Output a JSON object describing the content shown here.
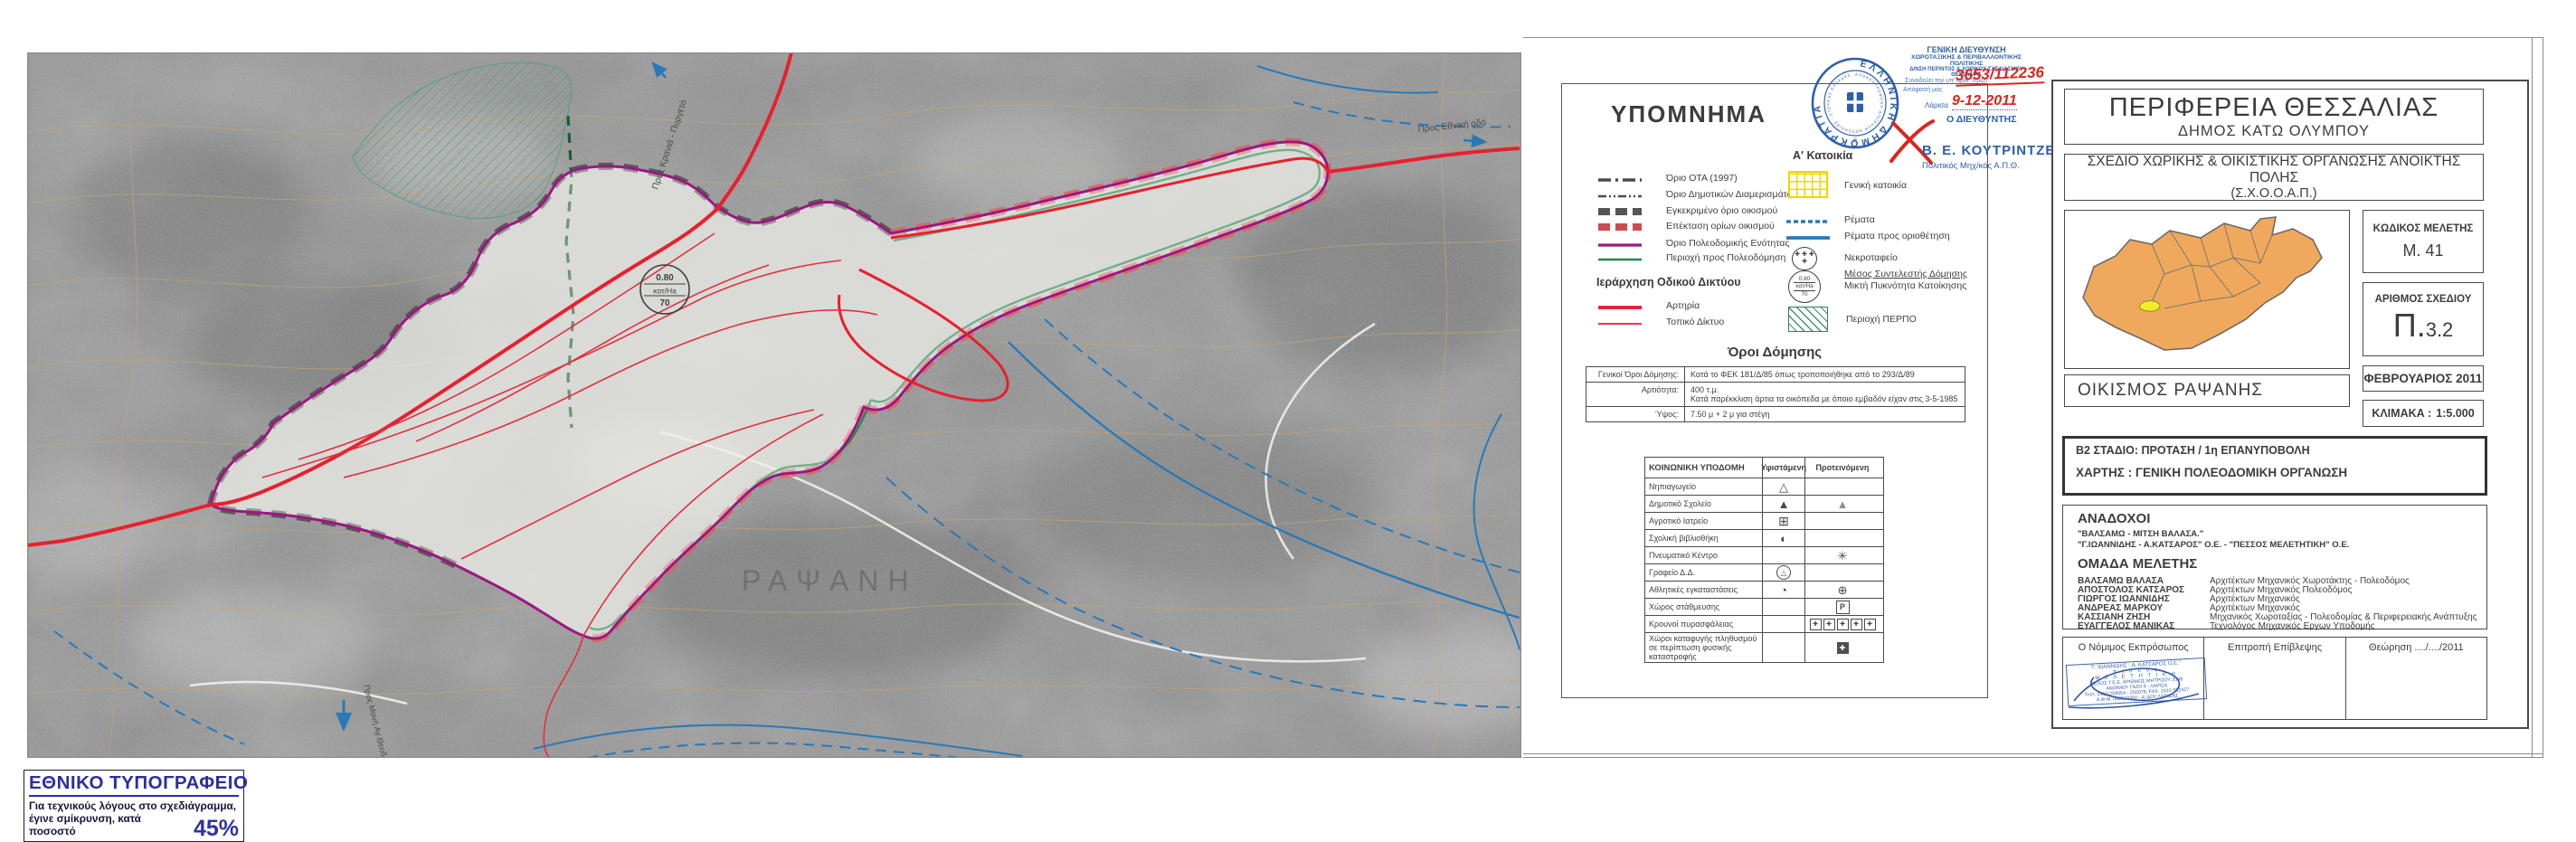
{
  "map": {
    "place_label": "ΡΑΨΑΝΗ",
    "label_north_road": "Προς Κρανιά - Πυργετό",
    "label_south_road": "Προς Μονή Αγ.Θεοδώρων",
    "label_east_road": "Προς Εθνική οδό",
    "density_circle": {
      "value": "0.80",
      "unit": "κατ/Ha",
      "density": "70"
    }
  },
  "legend": {
    "title": "ΥΠΟΜΝΗΜΑ",
    "boundaries": [
      {
        "label": "Όριο ΟΤΑ (1997)"
      },
      {
        "label": "Όριο Δημοτικών Διαμερισμάτων"
      },
      {
        "label": "Εγκεκριμένο όριο οικισμού"
      },
      {
        "label": "Επέκταση ορίων οικισμού"
      },
      {
        "label": "Όριο Πολεοδομικής Ενότητας"
      },
      {
        "label": "Περιοχή προς Πολεοδόμηση"
      }
    ],
    "roads_header": "Ιεράρχηση Οδικού Δικτύου",
    "roads": [
      {
        "label": "Αρτηρία"
      },
      {
        "label": "Τοπικό Δίκτυο"
      }
    ],
    "housing_header": "Α' Κατοικία",
    "area_items": [
      {
        "label": "Γενική κατοικία"
      },
      {
        "label": "Ρέματα"
      },
      {
        "label": "Ρέματα προς οριοθέτηση"
      },
      {
        "label": "Νεκροταφείο"
      },
      {
        "label": "Μέσος Συντελεστής Δόμησης",
        "label2": "Μικτή Πυκνότητα Κατοίκησης"
      },
      {
        "label": "Περιοχή ΠΕΡΠΟ"
      }
    ],
    "cemetery_glyphs": "✚ ✚ ✚ ✚",
    "building_terms": {
      "title": "Όροι Δόμησης",
      "rows": [
        {
          "label": "Γενικοί Όροι Δόμησης:",
          "value": "Κατά το ΦΕΚ 181/Δ/85 όπως τροποποιήθηκε από το 293/Δ/89",
          "value2": ""
        },
        {
          "label": "Αρτιότητα:",
          "value": "400 τ.μ.",
          "value2": "Κατά παρέκκλιση άρτια τα οικόπεδα με όποιο εμβαδόν είχαν στις 3-5-1985"
        },
        {
          "label": "Ύψος:",
          "value": "7.50 μ  + 2 μ  για στέγη",
          "value2": ""
        }
      ]
    },
    "infra_table": {
      "col1": "ΚΟΙΝΩΝΙΚΗ  ΥΠΟΔΟΜΗ",
      "col2": "Υφιστάμενη",
      "col3": "Προτεινόμενη",
      "rows": [
        {
          "label": "Νηπιαγωγείο",
          "existing": "△",
          "proposed": ""
        },
        {
          "label": "Δημοτικό Σχολείο",
          "existing": "▲",
          "proposed": "▲"
        },
        {
          "label": "Αγροτικό Ιατρείο",
          "existing": "⊞",
          "proposed": ""
        },
        {
          "label": "Σχολική βιβλιοθήκη",
          "existing": "◐",
          "proposed": ""
        },
        {
          "label": "Πνευματικό Κέντρο",
          "existing": "",
          "proposed": "✳"
        },
        {
          "label": "Γραφείο Δ.Δ.",
          "existing": "△",
          "proposed": ""
        },
        {
          "label": "Αθλητικές εγκαταστάσεις",
          "existing": "◔",
          "proposed": "⊕"
        },
        {
          "label": "Χώρος στάθμευσης",
          "existing": "",
          "proposed": "P"
        },
        {
          "label": "Κρουνοί πυρασφάλειας",
          "existing": "",
          "proposed": "✚"
        },
        {
          "label": "Χώροι καταφυγής πληθυσμού σε περίπτωση φυσικής καταστροφής",
          "existing": "",
          "proposed": "✚"
        }
      ]
    }
  },
  "stamp": {
    "dept1": "ΓΕΝΙΚΗ  ΔΙΕΥΘΥΝΣΗ",
    "dept2": "ΧΩΡΟΤΑΞΙΚΗΣ & ΠΕΡΙΒΑΛΛΟΝΤΙΚΗΣ ΠΟΛΙΤΙΚΗΣ",
    "dept3": "Δ/ΝΣΗ ΠΕΡ/ΝΤΟΣ & ΧΩΡΙΚΟΥ ΣΧΕΔΙΑΣΜΟΥ ΘΕΣΣΑΛΙΑΣ",
    "note1": "Συνοδεύει την υπ' αριθ. πρωτ.",
    "protocol": "3653/112236",
    "note2": "Απόφασή μας",
    "city": "Λάρισα",
    "date": "9-12-2011",
    "director": "Ο ΔΙΕΥΘΥΝΤΗΣ",
    "signer": "Β. Ε. ΚΟΥΤΡΙΝΤΖΕΣ",
    "signer_title": "Πολιτικός Μηχ/κός Α.Π.Θ.",
    "seal_text": "ΕΛΛΗΝΙΚΗ ΔΗΜΟΚΡΑΤΙΑ",
    "seal_inner_text": "ΑΠΟΚΕΝΤΡΩΜΕΝΗ ΔΙΟΙΚΗΣΗ ΘΕΣΣΑΛΙΑΣ - ΣΤΕΡΕΑΣ ΕΛΛΑΔΑΣ"
  },
  "titleblock": {
    "region": "ΠΕΡΙΦΕΡΕΙΑ ΘΕΣΣΑΛΙΑΣ",
    "municipality": "ΔΗΜΟΣ  ΚΑΤΩ  ΟΛΥΜΠΟΥ",
    "plan_type": "ΣΧΕΔΙΟ ΧΩΡΙΚΗΣ & ΟΙΚΙΣΤΙΚΗΣ ΟΡΓΑΝΩΣΗΣ ΑΝΟΙΚΤΗΣ ΠΟΛΗΣ",
    "plan_type_abbr": "(Σ.Χ.Ο.Ο.Α.Π.)",
    "study_code_label": "ΚΩΔΙΚΟΣ ΜΕΛΕΤΗΣ",
    "study_code": "Μ.  41",
    "sheet_no_label": "ΑΡΙΘΜΟΣ ΣΧΕΔΙΟΥ",
    "sheet_no_prefix": "Π.",
    "sheet_no": "3.2",
    "date": "ΦΕΒΡΟΥΑΡΙΟΣ 2011",
    "scale_label": "ΚΛΙΜΑΚΑ :",
    "scale": "1:5.000",
    "settlement": "ΟΙΚΙΣΜΟΣ  ΡΑΨΑΝΗΣ",
    "stage_line1": "Β2  ΣΤΑΔΙΟ: ΠΡΟΤΑΣΗ / 1η ΕΠΑΝΥΠΟΒΟΛΗ",
    "stage_line2": "ΧΑΡΤΗΣ : ΓΕΝΙΚΗ ΠΟΛΕΟΔΟΜΙΚΗ ΟΡΓΑΝΩΣΗ",
    "contractors_header": "ΑΝΑΔΟΧΟΙ",
    "contractors": [
      "\"ΒΑΛΣΑΜΩ - ΜΙΤΣΗ  ΒΑΛΑΣΑ.\"",
      "\"Γ.ΙΩΑΝΝΙΔΗΣ - Α.ΚΑΤΣΑΡΟΣ\" Ο.Ε. - \"ΠΕΣΣΟΣ ΜΕΛΕΤΗΤΙΚΗ\"  Ο.Ε."
    ],
    "team_header": "ΟΜΑΔΑ ΜΕΛΕΤΗΣ",
    "team": [
      {
        "name": "ΒΑΛΣΑΜΩ ΒΑΛΑΣΑ",
        "role": "Αρχιτέκτων Μηχανικός  Χωροτάκτης - Πολεοδόμος"
      },
      {
        "name": "ΑΠΟΣΤΟΛΟΣ ΚΑΤΣΑΡΟΣ",
        "role": "Αρχιτέκτων Μηχανικός  Πολεοδόμος"
      },
      {
        "name": "ΓΙΩΡΓΟΣ ΙΩΑΝΝΙΔΗΣ",
        "role": "Αρχιτέκτων Μηχανικός"
      },
      {
        "name": "ΑΝΔΡΕΑΣ ΜΑΡΚΟΥ",
        "role": "Αρχιτέκτων Μηχανικός"
      },
      {
        "name": "ΚΑΣΣΙΑΝΗ ΖΗΣΗ",
        "role": "Μηχανικός Χωροταξίας - Πολεοδομίας & Περιφερειακής Ανάπτυξης"
      },
      {
        "name": "ΕΥΑΓΓΕΛΟΣ ΜΑΝΙΚΑΣ",
        "role": "Τεχνολόγος Μηχανικός Εργων Υποδομής"
      }
    ],
    "signatures": {
      "legal_rep_label": "Ο Νόμιμος Εκπρόσωπος",
      "committee_label": "Επιτροπή Επίβλεψης",
      "approval_label": "Θεώρηση  ..../..../2011"
    },
    "firm_stamp_lines": [
      "\"Γ. ΙΩΑΝΝΙΔΗΣ - Α. ΚΑΤΣΑΡΟΣ Ο.Ε.\"",
      "π ε σ σ ό ς",
      "Μ Ε Λ Ε Τ Η Τ Ι Κ Η",
      "ΜΕΛΟΣ Τ.Ε.Ε. ΑΡΙΘΜΟΣ ΜΗΤΡΩΟΥ 3398",
      "ΑΝΘΙΜΟΥ ΓΑΖΗ 9 - ΛΑΡΙΣΑ",
      "ΤΗΛ. 2410 259554 - 250078, FAX. 2410 552427",
      "Α.Φ.Μ. 082503300 - Α' ΔΟΥ ΛΑΡΙΣΑΣ"
    ]
  },
  "footer_box": {
    "title": "ΕΘΝΙΚΟ ΤΥΠΟΓΡΑΦΕΙΟ",
    "line1": "Για τεχνικούς λόγους στο σχεδιάγραμμα,",
    "line2": "έγινε σμίκρυνση, κατά ποσοστό",
    "percent": "45%"
  }
}
